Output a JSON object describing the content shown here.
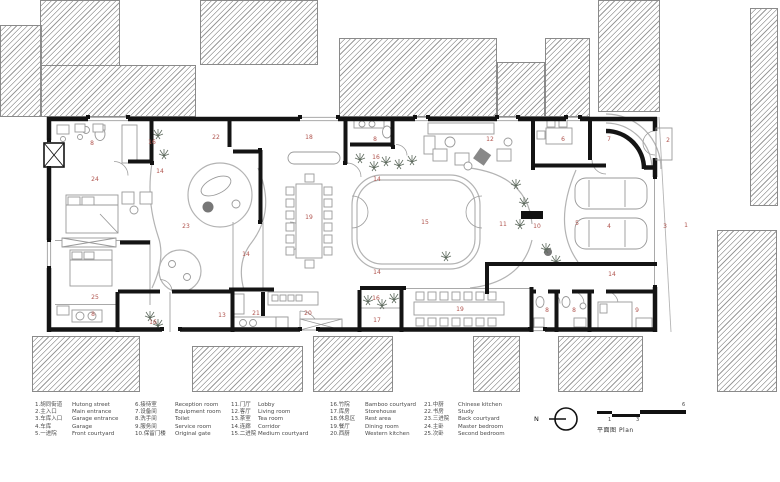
{
  "plan": {
    "label_color": "#b0544e",
    "room_labels": [
      {
        "n": "1",
        "x": 686,
        "y": 226
      },
      {
        "n": "2",
        "x": 668,
        "y": 141
      },
      {
        "n": "3",
        "x": 665,
        "y": 227
      },
      {
        "n": "4",
        "x": 609,
        "y": 227
      },
      {
        "n": "5",
        "x": 577,
        "y": 224
      },
      {
        "n": "6",
        "x": 563,
        "y": 140
      },
      {
        "n": "7",
        "x": 609,
        "y": 140
      },
      {
        "n": "8",
        "x": 92,
        "y": 144
      },
      {
        "n": "8",
        "x": 375,
        "y": 140
      },
      {
        "n": "8",
        "x": 93,
        "y": 315
      },
      {
        "n": "8",
        "x": 547,
        "y": 311
      },
      {
        "n": "8",
        "x": 574,
        "y": 311
      },
      {
        "n": "9",
        "x": 637,
        "y": 311
      },
      {
        "n": "10",
        "x": 537,
        "y": 227
      },
      {
        "n": "11",
        "x": 503,
        "y": 225
      },
      {
        "n": "12",
        "x": 490,
        "y": 140
      },
      {
        "n": "13",
        "x": 222,
        "y": 316
      },
      {
        "n": "14",
        "x": 160,
        "y": 172
      },
      {
        "n": "14",
        "x": 377,
        "y": 180
      },
      {
        "n": "14",
        "x": 246,
        "y": 255
      },
      {
        "n": "14",
        "x": 377,
        "y": 273
      },
      {
        "n": "14",
        "x": 612,
        "y": 275
      },
      {
        "n": "15",
        "x": 425,
        "y": 223
      },
      {
        "n": "16",
        "x": 152,
        "y": 143
      },
      {
        "n": "16",
        "x": 376,
        "y": 158
      },
      {
        "n": "16",
        "x": 153,
        "y": 323
      },
      {
        "n": "16",
        "x": 376,
        "y": 299
      },
      {
        "n": "17",
        "x": 377,
        "y": 321
      },
      {
        "n": "18",
        "x": 309,
        "y": 138
      },
      {
        "n": "19",
        "x": 309,
        "y": 218
      },
      {
        "n": "19",
        "x": 460,
        "y": 310
      },
      {
        "n": "20",
        "x": 308,
        "y": 314
      },
      {
        "n": "21",
        "x": 256,
        "y": 314
      },
      {
        "n": "22",
        "x": 216,
        "y": 138
      },
      {
        "n": "23",
        "x": 186,
        "y": 227
      },
      {
        "n": "24",
        "x": 95,
        "y": 180
      },
      {
        "n": "25",
        "x": 95,
        "y": 298
      }
    ]
  },
  "legend": {
    "columns": [
      [
        {
          "zh": "1.胡同街道",
          "en": "Hutong street"
        },
        {
          "zh": "2.主入口",
          "en": "Main entrance"
        },
        {
          "zh": "3.车库入口",
          "en": "Garage entrance"
        },
        {
          "zh": "4.车库",
          "en": "Garage"
        },
        {
          "zh": "5.一进院",
          "en": "Front courtyard"
        }
      ],
      [
        {
          "zh": "6.接待室",
          "en": "Reception room"
        },
        {
          "zh": "7.设备间",
          "en": "Equipment room"
        },
        {
          "zh": "8.洗手间",
          "en": "Toilet"
        },
        {
          "zh": "9.服务间",
          "en": "Service room"
        },
        {
          "zh": "10.保留门楼",
          "en": "Original gate"
        }
      ],
      [
        {
          "zh": "11.门厅",
          "en": "Lobby"
        },
        {
          "zh": "12.客厅",
          "en": "Living room"
        },
        {
          "zh": "13.茶室",
          "en": "Tea room"
        },
        {
          "zh": "14.连廊",
          "en": "Corridor"
        },
        {
          "zh": "15.二进院",
          "en": "Medium courtyard"
        }
      ],
      [
        {
          "zh": "16.竹院",
          "en": "Bamboo courtyard"
        },
        {
          "zh": "17.库房",
          "en": "Storehouse"
        },
        {
          "zh": "18.休息区",
          "en": "Rest area"
        },
        {
          "zh": "19.餐厅",
          "en": "Dining room"
        },
        {
          "zh": "20.西厨",
          "en": "Western kitchen"
        }
      ],
      [
        {
          "zh": "21.中厨",
          "en": "Chinese kitchen"
        },
        {
          "zh": "22.书房",
          "en": "Study"
        },
        {
          "zh": "23.三进院",
          "en": "Back courtyard"
        },
        {
          "zh": "24.主卧",
          "en": "Master bedroom"
        },
        {
          "zh": "25.次卧",
          "en": "Second bedroom"
        }
      ]
    ]
  },
  "footer": {
    "north_label": "N",
    "scale_ticks": [
      {
        "label": "1",
        "x": 11,
        "y": 12
      },
      {
        "label": "3",
        "x": 39,
        "y": 12
      },
      {
        "label": "6",
        "x": 85,
        "y": -3
      }
    ],
    "title_zh": "平面图",
    "title_en": "Plan"
  }
}
